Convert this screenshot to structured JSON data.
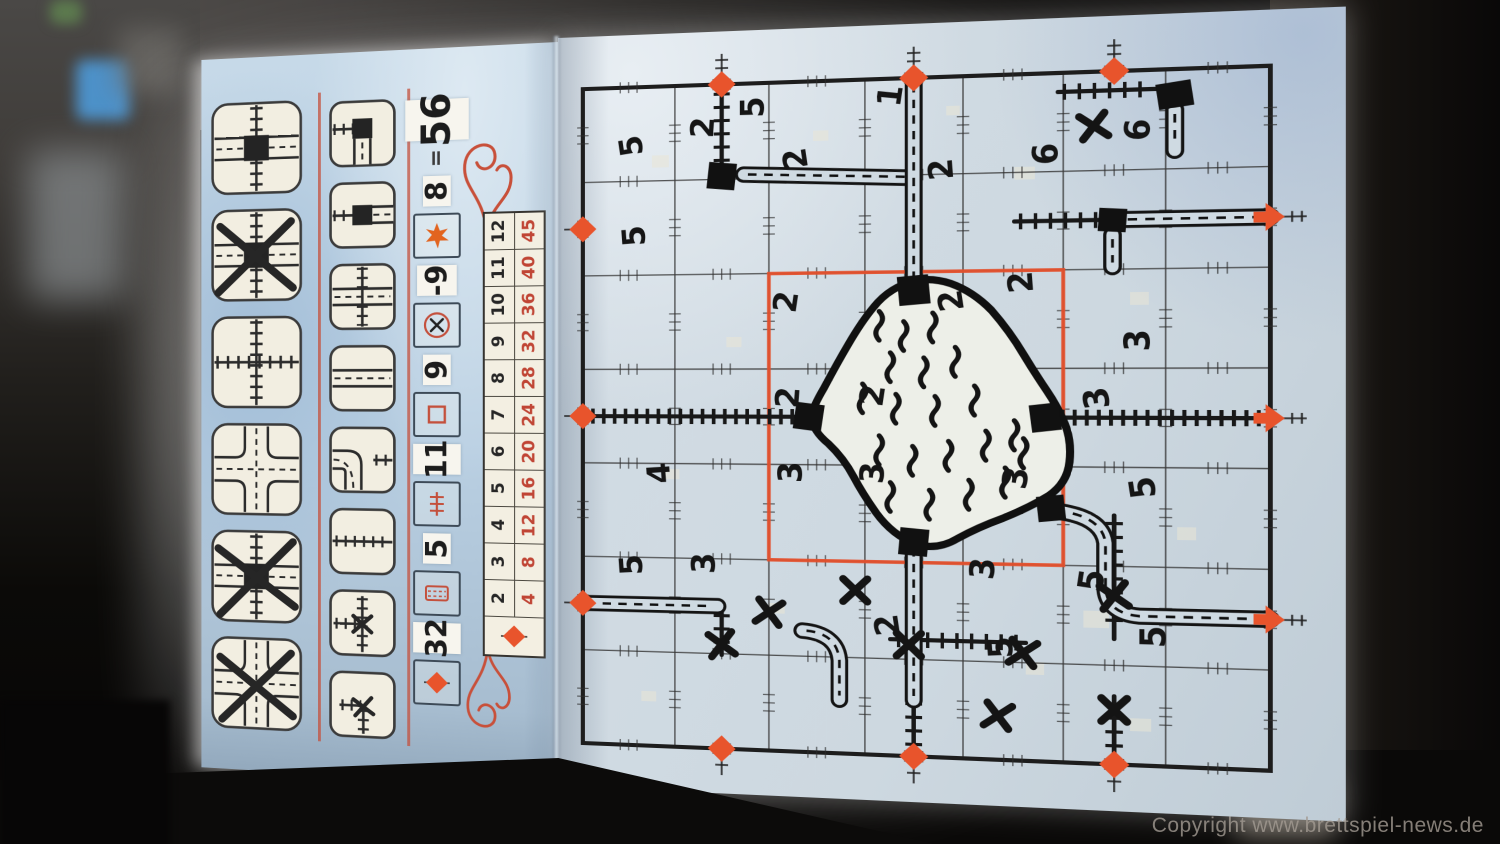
{
  "watermark": "Copyright www.brettspiel-news.de",
  "colors": {
    "accent": "#e8542c",
    "table_red": "#c04434",
    "ink": "#1b1b1b",
    "paper_left": "#b9cfe2",
    "paper_board": "#cfdae2"
  },
  "left_page": {
    "big_tiles": [
      "overpass-station-tile",
      "overpass-station-tile-crossed",
      "rail-crossroad-tile",
      "road-crossroad-tile",
      "overpass-station-tile-crossed",
      "road-crossroad-tile-crossed"
    ],
    "small_tiles": [
      "station-corner-tile",
      "station-straight-tile",
      "road-rail-crossing-tile",
      "road-straight-tile",
      "road-corner-rail-tile",
      "rail-straight-tile",
      "rail-tee-tile-crossed",
      "rail-corner-tile-crossed"
    ],
    "score": {
      "total": "56",
      "equals": "=",
      "entries": [
        {
          "icon": "exits-diamond-icon",
          "value": "32"
        },
        {
          "icon": "longest-road-icon",
          "value": "5"
        },
        {
          "icon": "longest-rail-icon",
          "value": "11"
        },
        {
          "icon": "center-cells-icon",
          "value": "9"
        },
        {
          "icon": "errors-icon",
          "value": "-9"
        },
        {
          "icon": "star-icon",
          "value": "8"
        }
      ]
    },
    "exits_table": {
      "exits_row": [
        "2",
        "3",
        "4",
        "5",
        "6",
        "7",
        "8",
        "9",
        "10",
        "11",
        "12"
      ],
      "points_row": [
        "4",
        "8",
        "12",
        "16",
        "20",
        "24",
        "28",
        "32",
        "36",
        "40",
        "45"
      ],
      "header_icon": "exits-diamond-icon"
    }
  },
  "board": {
    "cols": 7,
    "rows": 7,
    "exits": {
      "top": [
        2,
        4,
        6
      ],
      "bottom": [
        2,
        4,
        6
      ],
      "left": [
        2,
        4,
        6
      ],
      "right": [
        2,
        4,
        6
      ]
    },
    "center_zone": {
      "col_start": 3,
      "col_end": 5,
      "row_start": 3,
      "row_end": 5
    },
    "cell_numbers": [
      {
        "v": "5",
        "x": 0.55,
        "y": 0.62
      },
      {
        "v": "5",
        "x": 0.58,
        "y": 1.58
      },
      {
        "v": "5",
        "x": 1.85,
        "y": 0.25
      },
      {
        "v": "2",
        "x": 1.32,
        "y": 0.45
      },
      {
        "v": "1",
        "x": 3.28,
        "y": 0.18
      },
      {
        "v": "2",
        "x": 2.3,
        "y": 0.8
      },
      {
        "v": "2",
        "x": 3.8,
        "y": 0.95
      },
      {
        "v": "6",
        "x": 4.85,
        "y": 0.82
      },
      {
        "v": "6",
        "x": 5.75,
        "y": 0.6
      },
      {
        "v": "2",
        "x": 2.2,
        "y": 2.3
      },
      {
        "v": "2",
        "x": 3.9,
        "y": 2.3
      },
      {
        "v": "2",
        "x": 4.6,
        "y": 2.12
      },
      {
        "v": "3",
        "x": 5.75,
        "y": 2.72
      },
      {
        "v": "2",
        "x": 2.22,
        "y": 3.3
      },
      {
        "v": "2",
        "x": 3.1,
        "y": 3.28
      },
      {
        "v": "3",
        "x": 5.35,
        "y": 3.3
      },
      {
        "v": "4",
        "x": 0.85,
        "y": 4.1
      },
      {
        "v": "3",
        "x": 2.25,
        "y": 4.08
      },
      {
        "v": "3",
        "x": 3.1,
        "y": 4.08
      },
      {
        "v": "3",
        "x": 4.55,
        "y": 4.12
      },
      {
        "v": "5",
        "x": 5.8,
        "y": 4.2
      },
      {
        "v": "5",
        "x": 0.55,
        "y": 5.08
      },
      {
        "v": "3",
        "x": 1.33,
        "y": 5.05
      },
      {
        "v": "3",
        "x": 4.22,
        "y": 5.05
      },
      {
        "v": "5",
        "x": 5.3,
        "y": 5.15
      },
      {
        "v": "2",
        "x": 3.25,
        "y": 5.65
      },
      {
        "v": "5",
        "x": 4.4,
        "y": 5.85
      },
      {
        "v": "5",
        "x": 5.9,
        "y": 5.7
      }
    ],
    "x_marks": [
      {
        "x": 5.3,
        "y": 0.55
      },
      {
        "x": 2.9,
        "y": 5.3
      },
      {
        "x": 2.0,
        "y": 5.55
      },
      {
        "x": 1.5,
        "y": 5.9
      },
      {
        "x": 3.45,
        "y": 5.85
      },
      {
        "x": 4.6,
        "y": 5.9
      },
      {
        "x": 5.5,
        "y": 5.3
      },
      {
        "x": 5.5,
        "y": 6.45
      },
      {
        "x": 4.35,
        "y": 6.55
      }
    ]
  }
}
